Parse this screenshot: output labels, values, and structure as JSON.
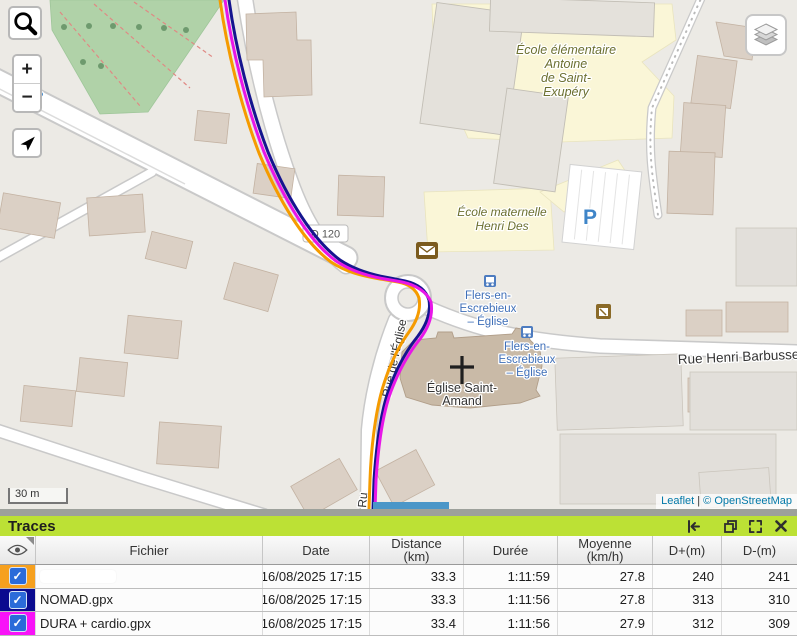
{
  "map": {
    "controls": {
      "zoom_in": "+",
      "zoom_out": "−"
    },
    "labels": {
      "school_elementary": [
        "École élémentaire",
        "Antoine",
        "de Saint-",
        "Exupéry"
      ],
      "school_nursery": [
        "École maternelle",
        "Henri Des"
      ],
      "bus_stop_a": [
        "Flers-en-",
        "Escrebieux",
        "– Église"
      ],
      "bus_stop_b": [
        "Flers-en-",
        "Escrebieux",
        "– Église"
      ],
      "church": [
        "Église Saint-",
        "Amand"
      ],
      "street_eglise": "Rue de l'Église",
      "street_eglise_partial": "Ru",
      "street_barbusse": "Rue Henri Barbusse",
      "road_ref": "D 120",
      "parking_large": "P",
      "parking_small": "P"
    },
    "scale_label": "30 m",
    "attribution": {
      "leaflet": "Leaflet",
      "separator": "|",
      "osm": "© OpenStreetMap"
    }
  },
  "panel": {
    "title": "Traces",
    "header": {
      "fichier": "Fichier",
      "date": "Date",
      "distance_1": "Distance",
      "distance_2": "(km)",
      "duree": "Durée",
      "moyenne_1": "Moyenne",
      "moyenne_2": "(km/h)",
      "dplus": "D+(m)",
      "dminus": "D-(m)"
    },
    "rows": [
      {
        "file": "",
        "date": "16/08/2025 17:15",
        "distance": "33.3",
        "duree": "1:11:59",
        "moyenne": "27.8",
        "dplus": "240",
        "dminus": "241",
        "color": "#F6A01E",
        "checked": "✓"
      },
      {
        "file": "NOMAD.gpx",
        "date": "16/08/2025 17:15",
        "distance": "33.3",
        "duree": "1:11:56",
        "moyenne": "27.8",
        "dplus": "313",
        "dminus": "310",
        "color": "#0A0A8F",
        "checked": "✓"
      },
      {
        "file": "DURA + cardio.gpx",
        "date": "16/08/2025 17:15",
        "distance": "33.4",
        "duree": "1:11:56",
        "moyenne": "27.9",
        "dplus": "312",
        "dminus": "309",
        "color": "#F812F8",
        "checked": "✓"
      }
    ]
  },
  "colors": {
    "trace_orange": "#F59B00",
    "trace_navy": "#15158F",
    "trace_magenta": "#E816E8",
    "panel_green": "#BCE135",
    "scrollbar_blue": "#4A96C8"
  },
  "icons": {
    "search": "magnifier",
    "locate": "navigation-arrow",
    "layers": "stacked-layers",
    "eye": "eye",
    "collapse": "dock-left-arrow",
    "restore": "overlapping-windows",
    "fullscreen": "expand-arrows",
    "close": "x",
    "checkbox": "checkmark",
    "post": "envelope",
    "bus": "bus-stop",
    "shop": "shop"
  }
}
